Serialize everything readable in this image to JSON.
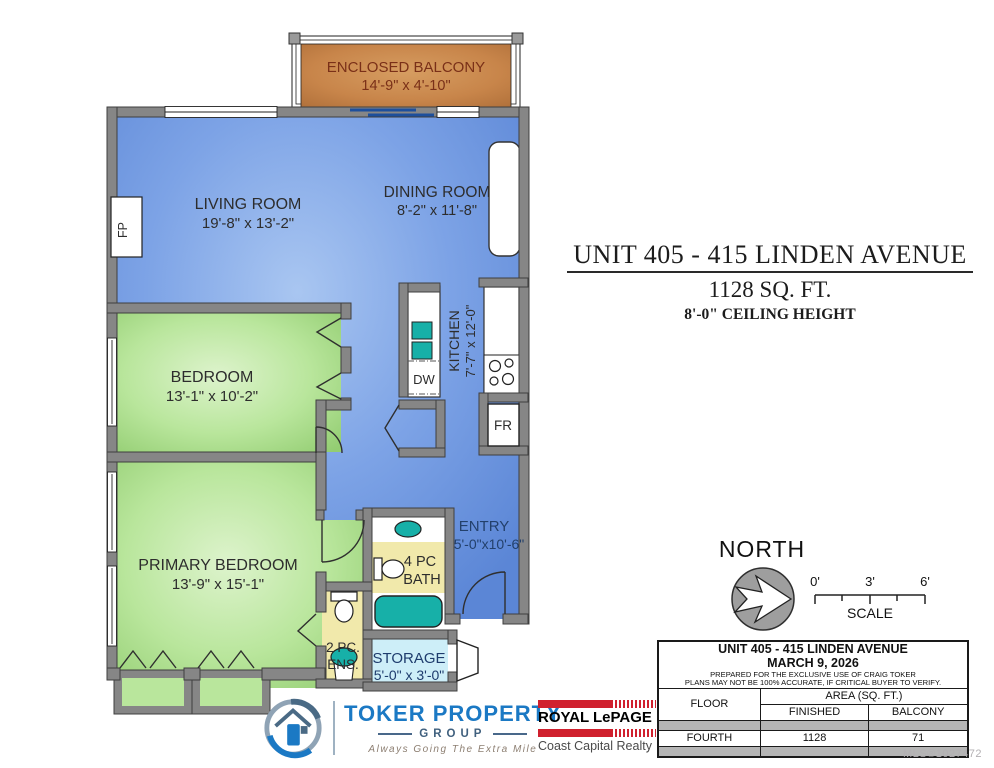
{
  "floorplan": {
    "rooms": {
      "balcony": {
        "name": "ENCLOSED BALCONY",
        "dims": "14'-9\" x 4'-10\""
      },
      "living": {
        "name": "LIVING ROOM",
        "dims": "19'-8\" x 13'-2\""
      },
      "dining": {
        "name": "DINING ROOM",
        "dims": "8'-2\" x 11'-8\""
      },
      "kitchen": {
        "name": "KITCHEN",
        "dims": "7'-7\" x 12'-0\""
      },
      "bedroom": {
        "name": "BEDROOM",
        "dims": "13'-1\" x 10'-2\""
      },
      "primary": {
        "name": "PRIMARY BEDROOM",
        "dims": "13'-9\" x 15'-1\""
      },
      "entry": {
        "name": "ENTRY",
        "dims": "5'-0\"x10'-6\""
      },
      "bath": {
        "line1": "4 PC",
        "line2": "BATH"
      },
      "ensuite": {
        "line1": "2 PC.",
        "line2": "ENS."
      },
      "storage": {
        "name": "STORAGE",
        "dims": "5'-0\" x 3'-0\""
      }
    },
    "fixtures": {
      "dishwasher": "DW",
      "fridge": "FR",
      "fireplace": "FP"
    }
  },
  "title_block": {
    "address": "UNIT 405 - 415 LINDEN AVENUE",
    "area": "1128 SQ. FT.",
    "ceiling": "8'-0\" CEILING HEIGHT"
  },
  "compass": {
    "label": "NORTH"
  },
  "scale_bar": {
    "tick0": "0'",
    "tick3": "3'",
    "tick6": "6'",
    "label": "SCALE"
  },
  "info_table": {
    "title": "UNIT 405 - 415 LINDEN AVENUE",
    "date": "MARCH 9, 2026",
    "note1": "PREPARED FOR THE EXCLUSIVE USE OF CRAIG TOKER",
    "note2": "PLANS MAY NOT BE 100% ACCURATE, IF CRITICAL BUYER TO VERIFY.",
    "col_floor": "FLOOR",
    "col_area": "AREA (SQ. FT.)",
    "col_finished": "FINISHED",
    "col_balcony": "BALCONY",
    "rows": [
      {
        "floor": "FOURTH",
        "finished": "1128",
        "balcony": "71"
      }
    ]
  },
  "branding": {
    "toker": {
      "name": "TOKER PROPERTY",
      "group": "GROUP",
      "tagline": "Always Going The Extra Mile"
    },
    "royal": {
      "name": "ROYAL LePAGE",
      "sub": "Coast Capital Realty"
    }
  },
  "watermark": "MLS®1027472",
  "colors": {
    "room_blue": "#6f99e2",
    "room_green": "#b9e69c",
    "balcony_orange": "#c8854a",
    "bath_yellow": "#f1e9ab",
    "storage_cyan": "#cdeef8",
    "fixture_teal": "#17b0a8",
    "wall_gray": "#868686",
    "toker_blue": "#1b79c4",
    "royal_red": "#d0202e"
  }
}
